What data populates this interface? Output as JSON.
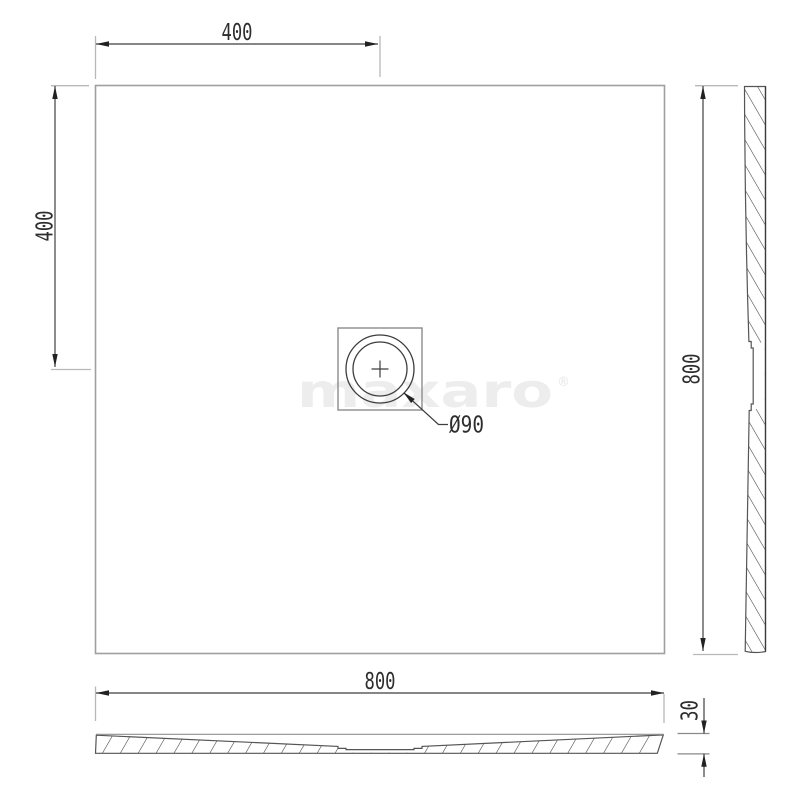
{
  "drawing": {
    "dimensions": {
      "drain_offset_x": "400",
      "drain_offset_y": "400",
      "overall_width": "800",
      "overall_depth": "800",
      "tray_height": "30",
      "drain_diameter": "Ø90"
    }
  },
  "watermark": {
    "text": "maxaro",
    "registered_mark": "®"
  },
  "colors": {
    "background": "#ffffff",
    "outline": "#a0a0a0",
    "drain_box": "#8c8c8c",
    "drain_circle": "#3d3d3d",
    "dimension_line": "#3f3f3f",
    "extension_line": "#b8b8b8",
    "extension_dark": "#8a8a8a",
    "arrow": "#222222",
    "section_line": "#555555",
    "hatch": "#3d3d3d",
    "text": "#2d2d2d",
    "watermark": "#ededed"
  }
}
